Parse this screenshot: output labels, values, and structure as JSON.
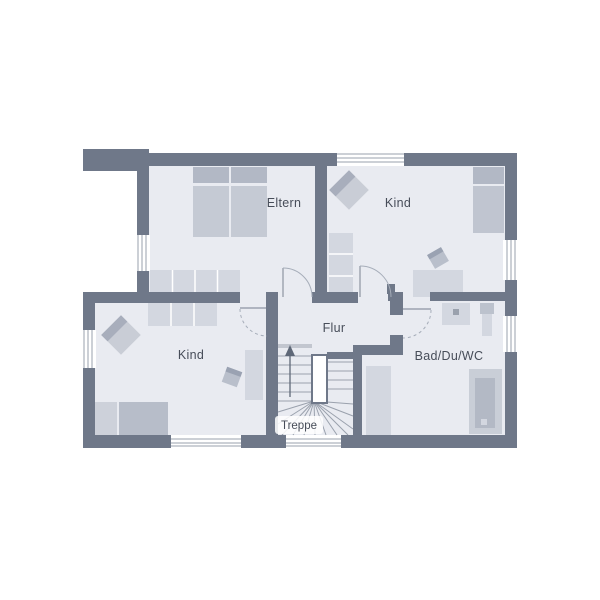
{
  "plan": {
    "type": "floor-plan",
    "language": "de",
    "palette": {
      "wall": "#6f7889",
      "floor": "#e9ebf1",
      "furniture_light": "#d3d7e0",
      "furniture_mid": "#c5cad4",
      "furniture_dark": "#acb3c1",
      "line": "#9aa1ad",
      "text": "#474d59",
      "background": "#ffffff"
    },
    "rooms": [
      {
        "id": "eltern",
        "label": "Eltern",
        "furniture": [
          "double-bed",
          "wardrobe"
        ]
      },
      {
        "id": "kind-ost",
        "label": "Kind",
        "furniture": [
          "bed",
          "wardrobe",
          "desk",
          "chair",
          "armchair"
        ]
      },
      {
        "id": "kind-west",
        "label": "Kind",
        "furniture": [
          "bed",
          "wardrobe",
          "desk",
          "chair",
          "armchair"
        ]
      },
      {
        "id": "flur",
        "label": "Flur",
        "furniture": []
      },
      {
        "id": "bad",
        "label": "Bad/Du/WC",
        "furniture": [
          "washbasin",
          "wc",
          "shower",
          "cabinet"
        ]
      },
      {
        "id": "treppe",
        "label": "Treppe",
        "furniture": [
          "winder-staircase",
          "up-arrow"
        ]
      }
    ]
  }
}
